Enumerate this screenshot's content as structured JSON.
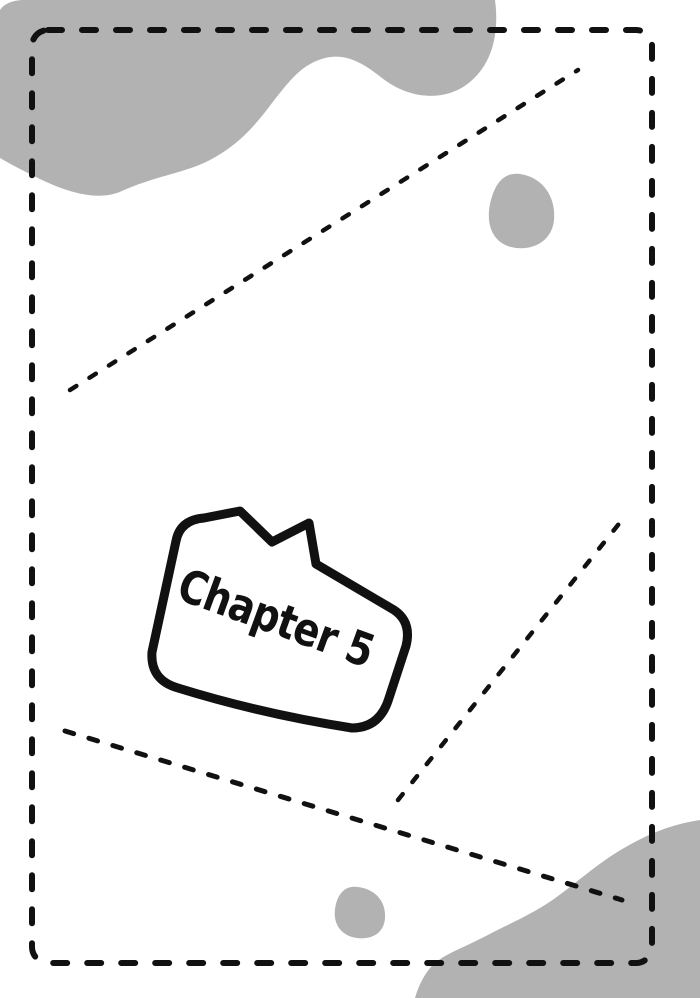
{
  "page": {
    "kind": "comic-chapter-title-page",
    "bubble": {
      "label": "Chapter 5"
    }
  },
  "colors": {
    "background": "#ffffff",
    "blob_gray": "#b2b2b2",
    "ink": "#111111",
    "bubble_fill": "#ffffff"
  }
}
